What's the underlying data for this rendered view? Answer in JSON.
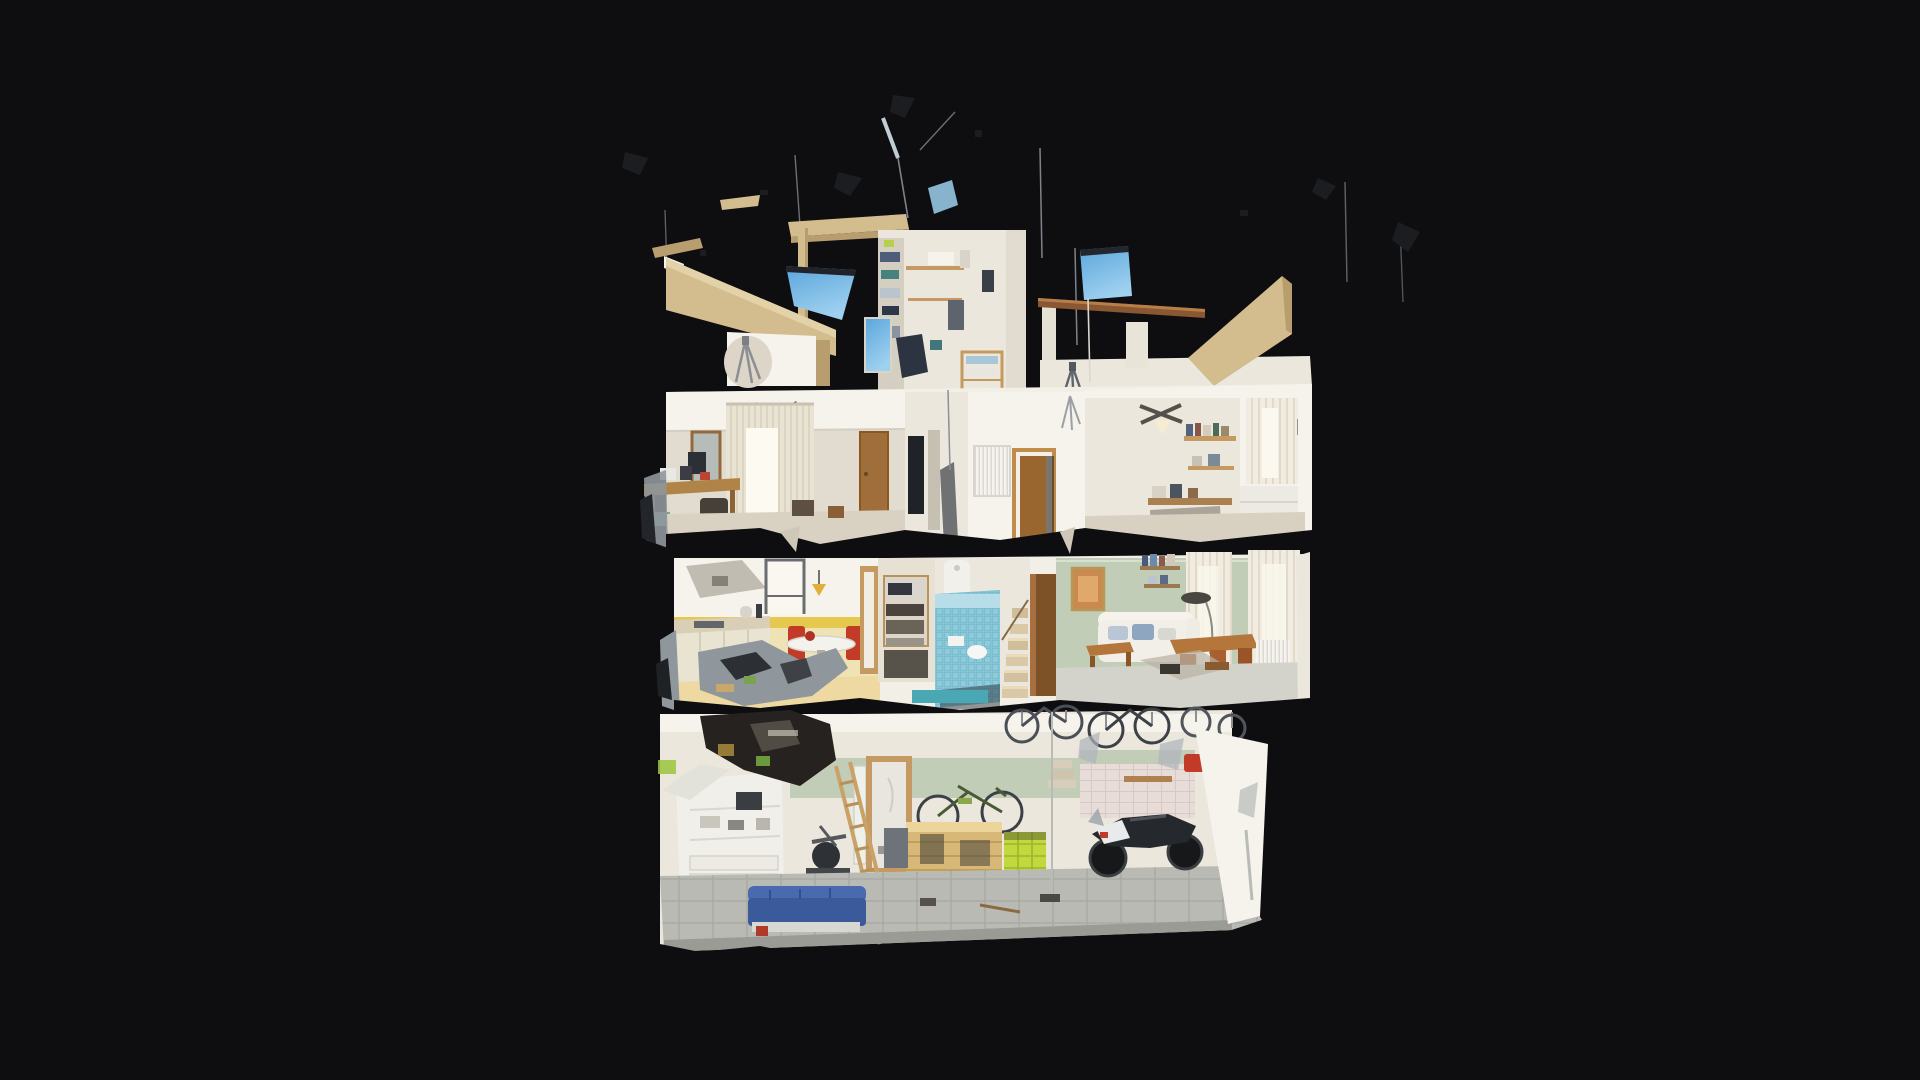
{
  "app": {
    "view_label": "dollhouse-cutaway-3d-model",
    "background_note": "full-bleed dark viewer canvas, no visible UI chrome or text"
  },
  "palette": {
    "bg": "#0e0e11",
    "slab": "#f2efe7",
    "wall": "#ece7dd",
    "wall_bright": "#f6f3ec",
    "wall_dim": "#e2dcd0",
    "tan": "#d3bd8e",
    "tan_dark": "#b89e6e",
    "wood": "#a9743c",
    "wood_dark": "#7d5226",
    "wood_light": "#c49a62",
    "sage": "#c2cdb8",
    "yellow_tile": "#e5c94e",
    "yellow_wall": "#efe2b4",
    "yellow_floor": "#eed9a2",
    "sky": "#6cb2e2",
    "sky_light": "#9ed0ef",
    "pool": "#86c6d6",
    "pool_dark": "#68aec2",
    "red": "#c23a28",
    "lime": "#c2d83c",
    "teal": "#49a8b4",
    "metal": "#9aa2a8",
    "glitch": "#8f969c",
    "dark": "#1c1d20",
    "gap": "#0a0a0c",
    "gray_floor": "#b9bab4",
    "denim": "#4a6ab0"
  },
  "scene": {
    "model": "three-storey house cross-section scan with rooftop terrace",
    "floors": [
      {
        "name": "roof-terrace",
        "features": [
          "scan-artifact-fragments",
          "blue-sky-patches",
          "antenna-lines",
          "tan-parapet-wall",
          "tripod-ghost-shadow",
          "laundry-tower-shelves",
          "hanging-clothes",
          "wooden-clothesline-beam",
          "slanted-tan-wall"
        ]
      },
      {
        "name": "bedroom-level",
        "rooms": [
          "master-bedroom",
          "stair-landing",
          "radiator-hall",
          "office-bedroom"
        ],
        "features": [
          "ceiling-fan",
          "vertical-blinds",
          "wall-mirror",
          "cluttered-desk",
          "wooden-doors",
          "radiator",
          "book-shelves",
          "window-curtains"
        ]
      },
      {
        "name": "kitchen-living-level",
        "rooms": [
          "kitchen",
          "pantry-shelves",
          "blue-mosaic-bathroom",
          "staircase",
          "living-room"
        ],
        "features": [
          "yellow-tile-band",
          "kitchen-window",
          "round-table",
          "red-chairs",
          "counter",
          "microwave",
          "shower-column",
          "wood-wardrobe",
          "framed-picture",
          "white-sofa-blue-pillows",
          "coffee-table",
          "dining-table",
          "arc-lamp",
          "sheer-curtains",
          "torn-floor-glitch"
        ]
      },
      {
        "name": "garage-level",
        "rooms": [
          "laundry-bathroom",
          "garage"
        ],
        "features": [
          "white-cabinet",
          "mirror",
          "doorway",
          "leaning-ladder",
          "elliptical-trainer",
          "mountain-bike-on-crate",
          "wooden-crate",
          "lime-crate",
          "hanging-bicycles",
          "motorcycle",
          "blue-bench",
          "sage-wall-band",
          "pink-tile-wall",
          "concrete-tile-floor"
        ]
      }
    ]
  }
}
